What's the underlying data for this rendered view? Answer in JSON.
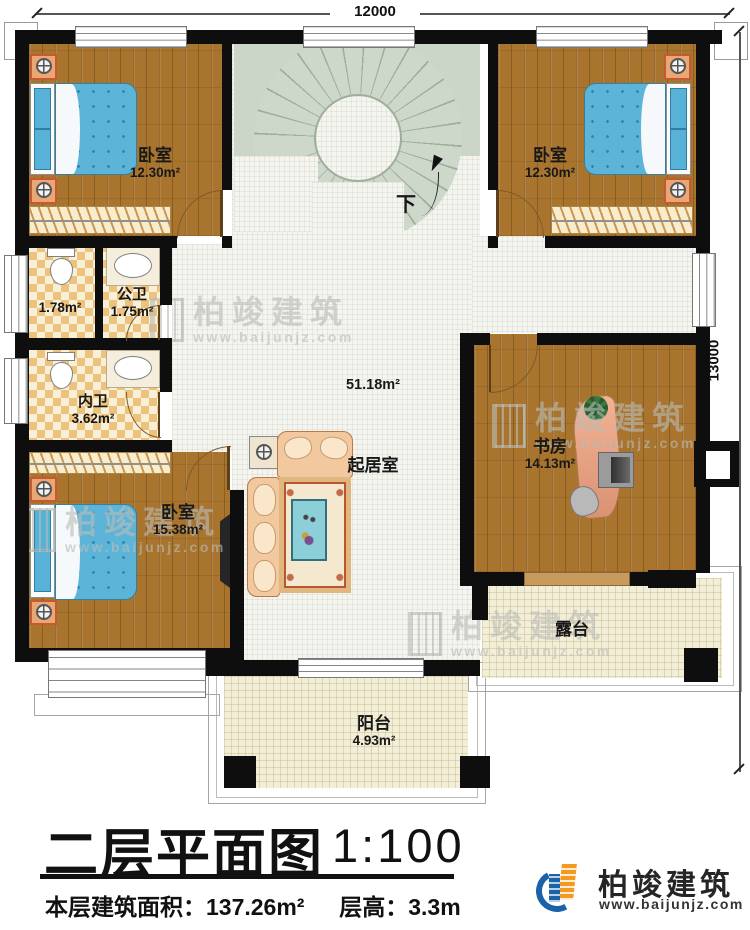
{
  "titleblock": {
    "plan_title": "二层平面图",
    "scale": "1:100",
    "area_label": "本层建筑面积：",
    "area_value": "137.26m²",
    "floor_height_label": "层高：",
    "floor_height_value": "3.3m"
  },
  "dimensions": {
    "top": "12000",
    "right": "13000"
  },
  "stairs": {
    "down_label": "下"
  },
  "rooms": {
    "bedroom_tl": {
      "name": "卧室",
      "area": "12.30m²"
    },
    "bedroom_tr": {
      "name": "卧室",
      "area": "12.30m²"
    },
    "bathroom_public": {
      "name": "公卫",
      "area": "1.75m²",
      "stall_area": "1.78m²"
    },
    "bathroom_private": {
      "name": "内卫",
      "area": "3.62m²"
    },
    "bedroom_bl": {
      "name": "卧室",
      "area": "15.38m²"
    },
    "living": {
      "name": "起居室",
      "area": "51.18m²"
    },
    "study": {
      "name": "书房",
      "area": "14.13m²"
    },
    "terrace": {
      "name": "露台"
    },
    "balcony": {
      "name": "阳台",
      "area": "4.93m²"
    }
  },
  "branding": {
    "company": "柏竣建筑",
    "website": "www.baijunjz.com"
  },
  "watermark": {
    "company": "柏竣建筑",
    "website": "www.baijunjz.com"
  },
  "colors": {
    "wall": "#0e0e0e",
    "wood_floor": "#a9752e",
    "bed_blue": "#5cb5d9",
    "stair_gray": "#cbd5c8",
    "tile_checker": "#ecc27c",
    "terrace_cream": "#f3eed8",
    "logo_blue": "#1a63a8",
    "logo_orange": "#f59a1e"
  }
}
